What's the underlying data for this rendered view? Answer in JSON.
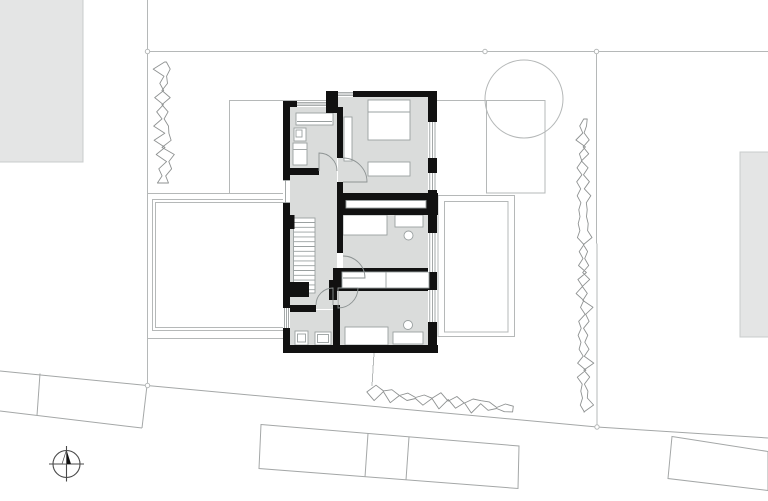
{
  "canvas": {
    "width": 768,
    "height": 501
  },
  "drawing": {
    "kind": "architectural site / floor plan",
    "text_labels": []
  },
  "colors": {
    "background": "#ffffff",
    "site_line": "#b5b8b8",
    "road_line": "#a4a7a7",
    "hedge_line": "#8f9292",
    "wall": "#111111",
    "floor": "#dadcdb",
    "furniture_fill": "#ffffff",
    "furniture_stroke": "#9aa0a0",
    "neighbor_fill": "#e4e5e5",
    "neighbor_stroke": "#c9cccc",
    "compass": "#4a4a4a"
  }
}
